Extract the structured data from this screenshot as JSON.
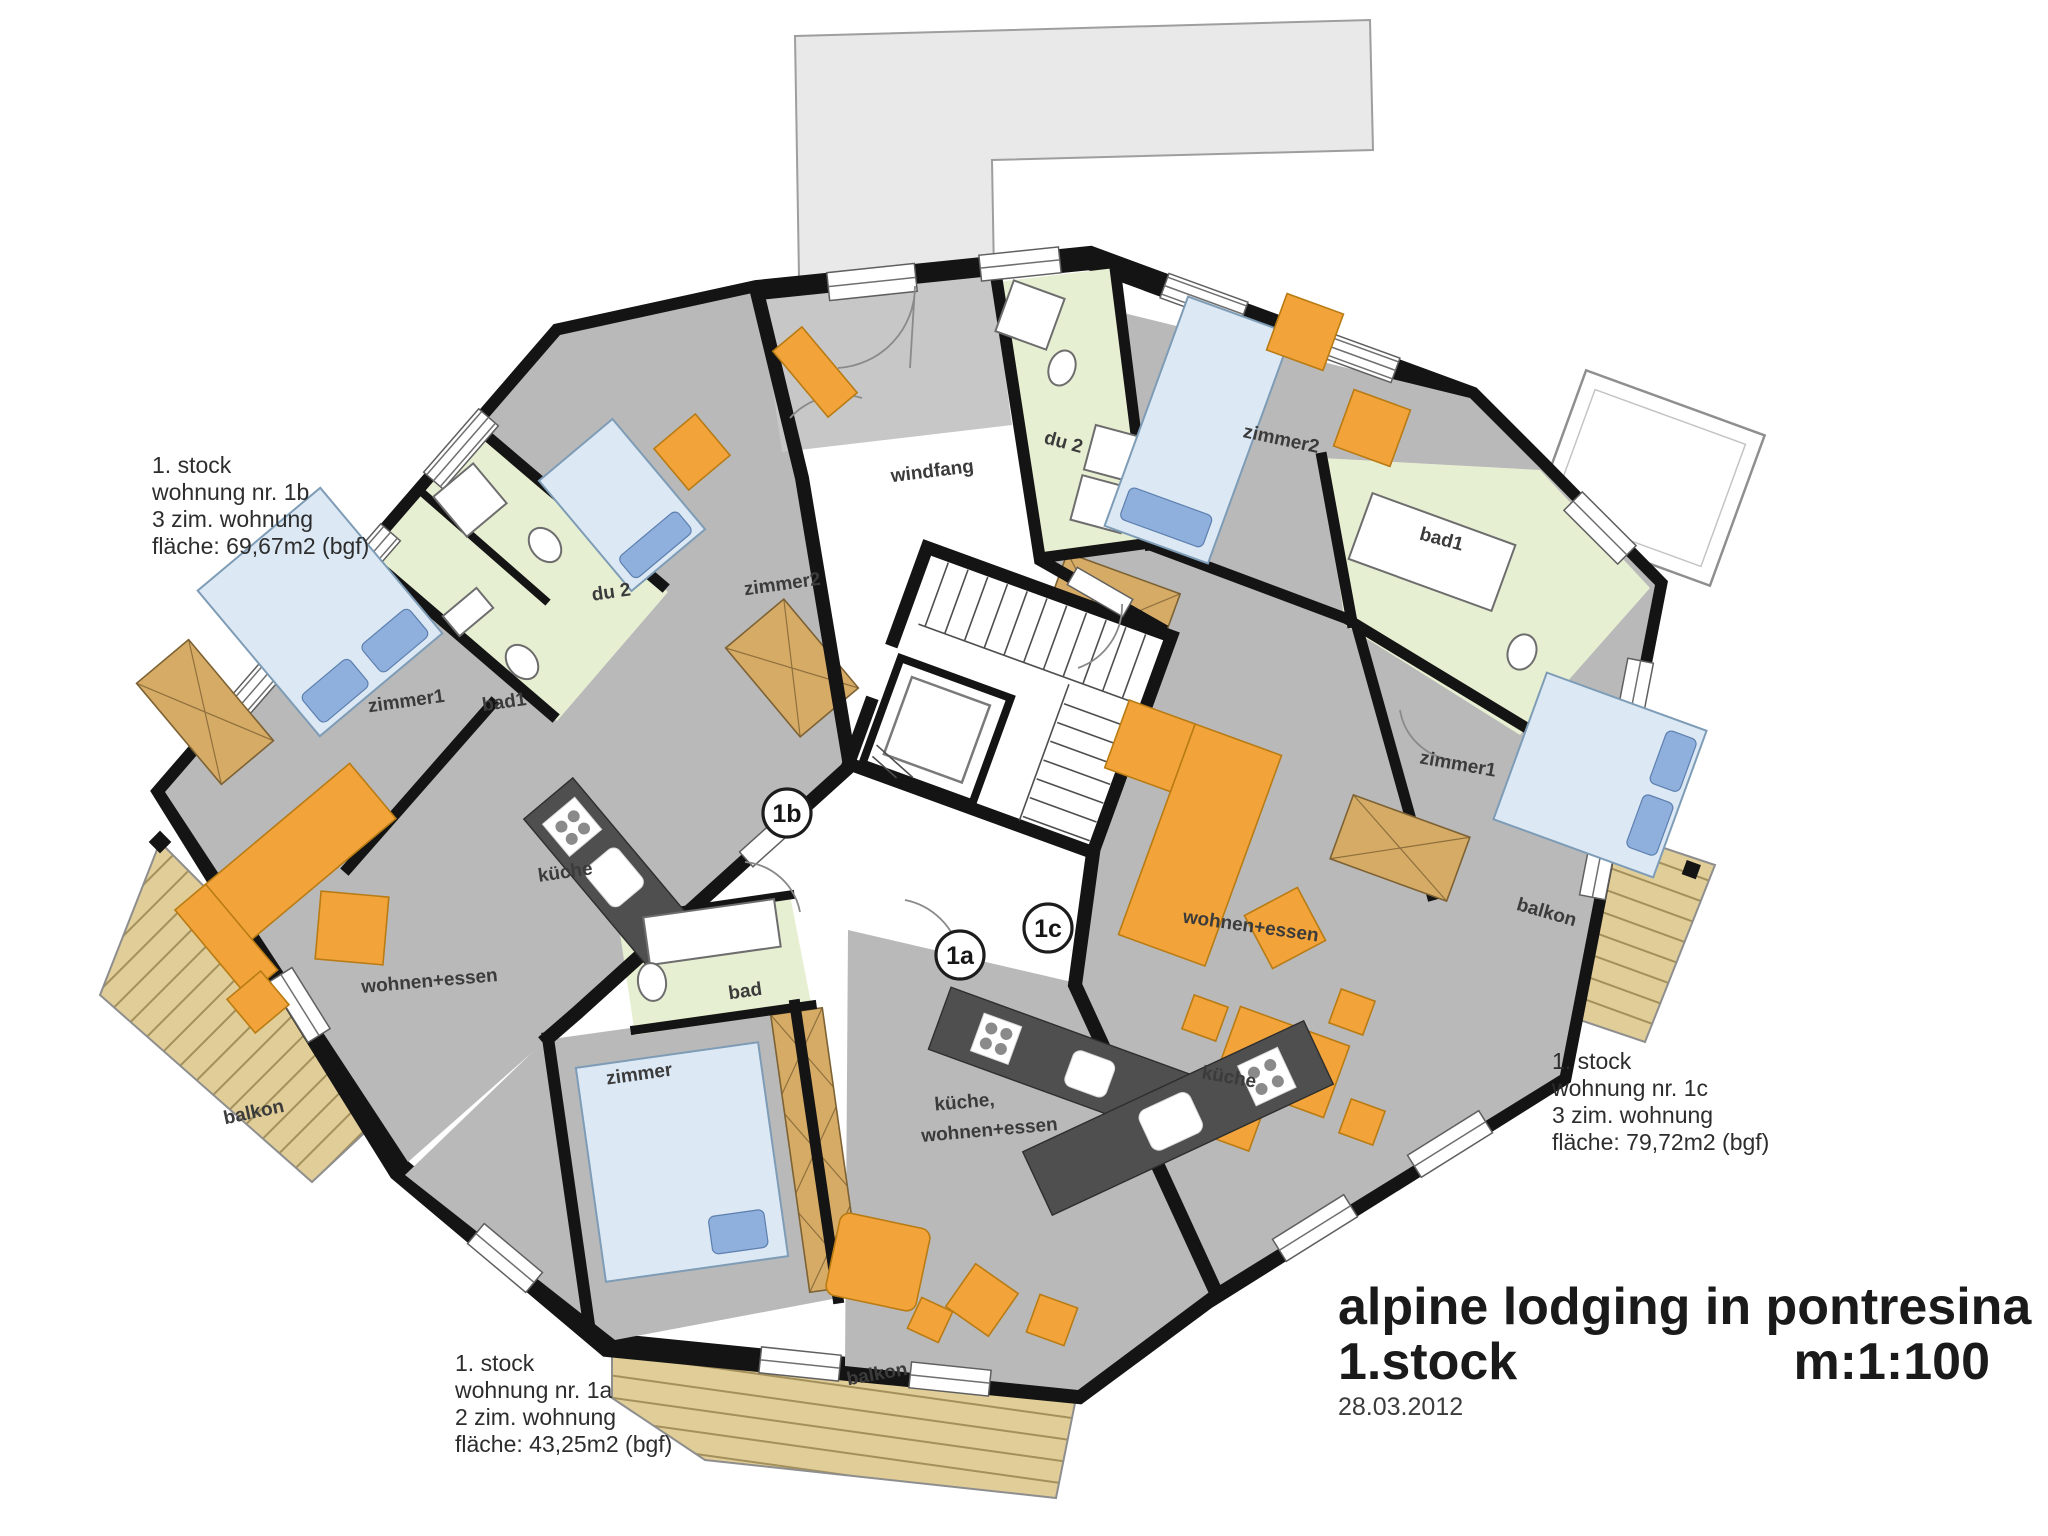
{
  "colors": {
    "wall": "#141414",
    "floor": "#b9b9b9",
    "floor-light": "#c7c7c7",
    "bath": "#e7efd2",
    "furniture": "#f2a43a",
    "wood": "#d6ab66",
    "deck": "#e0cd97",
    "deck-stripe": "#a3905c",
    "bed": "#dce9f5",
    "bed-accent": "#8fb0dc",
    "counter": "#4f4f4f",
    "adjacent": "#e9e9e9",
    "label": "#3b3b3b"
  },
  "title_block": {
    "project": "alpine lodging in pontresina",
    "floor": "1.stock",
    "scale": "m:1:100",
    "date": "28.03.2012"
  },
  "apartments": {
    "b": {
      "marker": "1b",
      "line1": "1. stock",
      "line2": "wohnung nr. 1b",
      "line3": "3 zim. wohnung",
      "line4": "fläche: 69,67m2 (bgf)"
    },
    "a": {
      "marker": "1a",
      "line1": "1. stock",
      "line2": "wohnung nr. 1a",
      "line3": "2 zim. wohnung",
      "line4": "fläche: 43,25m2 (bgf)"
    },
    "c": {
      "marker": "1c",
      "line1": "1. stock",
      "line2": "wohnung nr. 1c",
      "line3": "3 zim. wohnung",
      "line4": "fläche: 79,72m2 (bgf)"
    }
  },
  "rooms": {
    "windfang": "windfang",
    "b_zimmer1": "zimmer1",
    "b_bad1": "bad1",
    "b_du2": "du 2",
    "b_zimmer2": "zimmer2",
    "b_kueche": "küche",
    "b_wohnen": "wohnen+essen",
    "b_balkon": "balkon",
    "a_bad": "bad",
    "a_zimmer": "zimmer",
    "a_kueche": "küche,",
    "a_wohnen": "wohnen+essen",
    "a_balkon": "balkon",
    "c_du2": "du 2",
    "c_zimmer2": "zimmer2",
    "c_bad1": "bad1",
    "c_zimmer1": "zimmer1",
    "c_wohnen": "wohnen+essen",
    "c_kueche": "küche",
    "c_balkon": "balkon"
  }
}
